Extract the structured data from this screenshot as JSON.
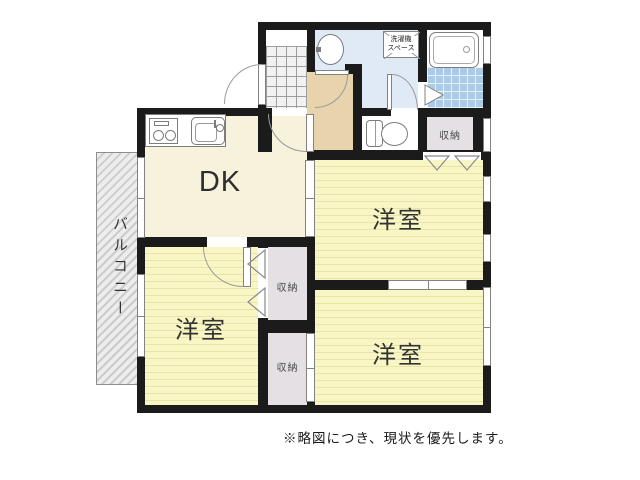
{
  "rooms": {
    "dk": {
      "label": "DK"
    },
    "bedroom_ne": {
      "label": "洋室"
    },
    "bedroom_sw": {
      "label": "洋室"
    },
    "bedroom_se": {
      "label": "洋室"
    }
  },
  "balcony": {
    "label": "バルコニー"
  },
  "laundry_space": {
    "line1": "洗濯機",
    "line2": "スペース"
  },
  "closets": {
    "ne": {
      "label": "収納"
    },
    "mid": {
      "label": "収納"
    },
    "south": {
      "label": "収納"
    }
  },
  "note": "※略図につき、現状を優先します。",
  "colors": {
    "wall": "#1b1b1b",
    "bedroom_fill": "#f9f6c6",
    "dk_fill": "#f6f2dc",
    "hallway_fill": "#e8d4ac",
    "washroom_fill": "#e0eaf6",
    "bath_tile": "#abcbe9",
    "closet_fill": "#e4e0e4",
    "balcony_fill": "#ededed"
  }
}
